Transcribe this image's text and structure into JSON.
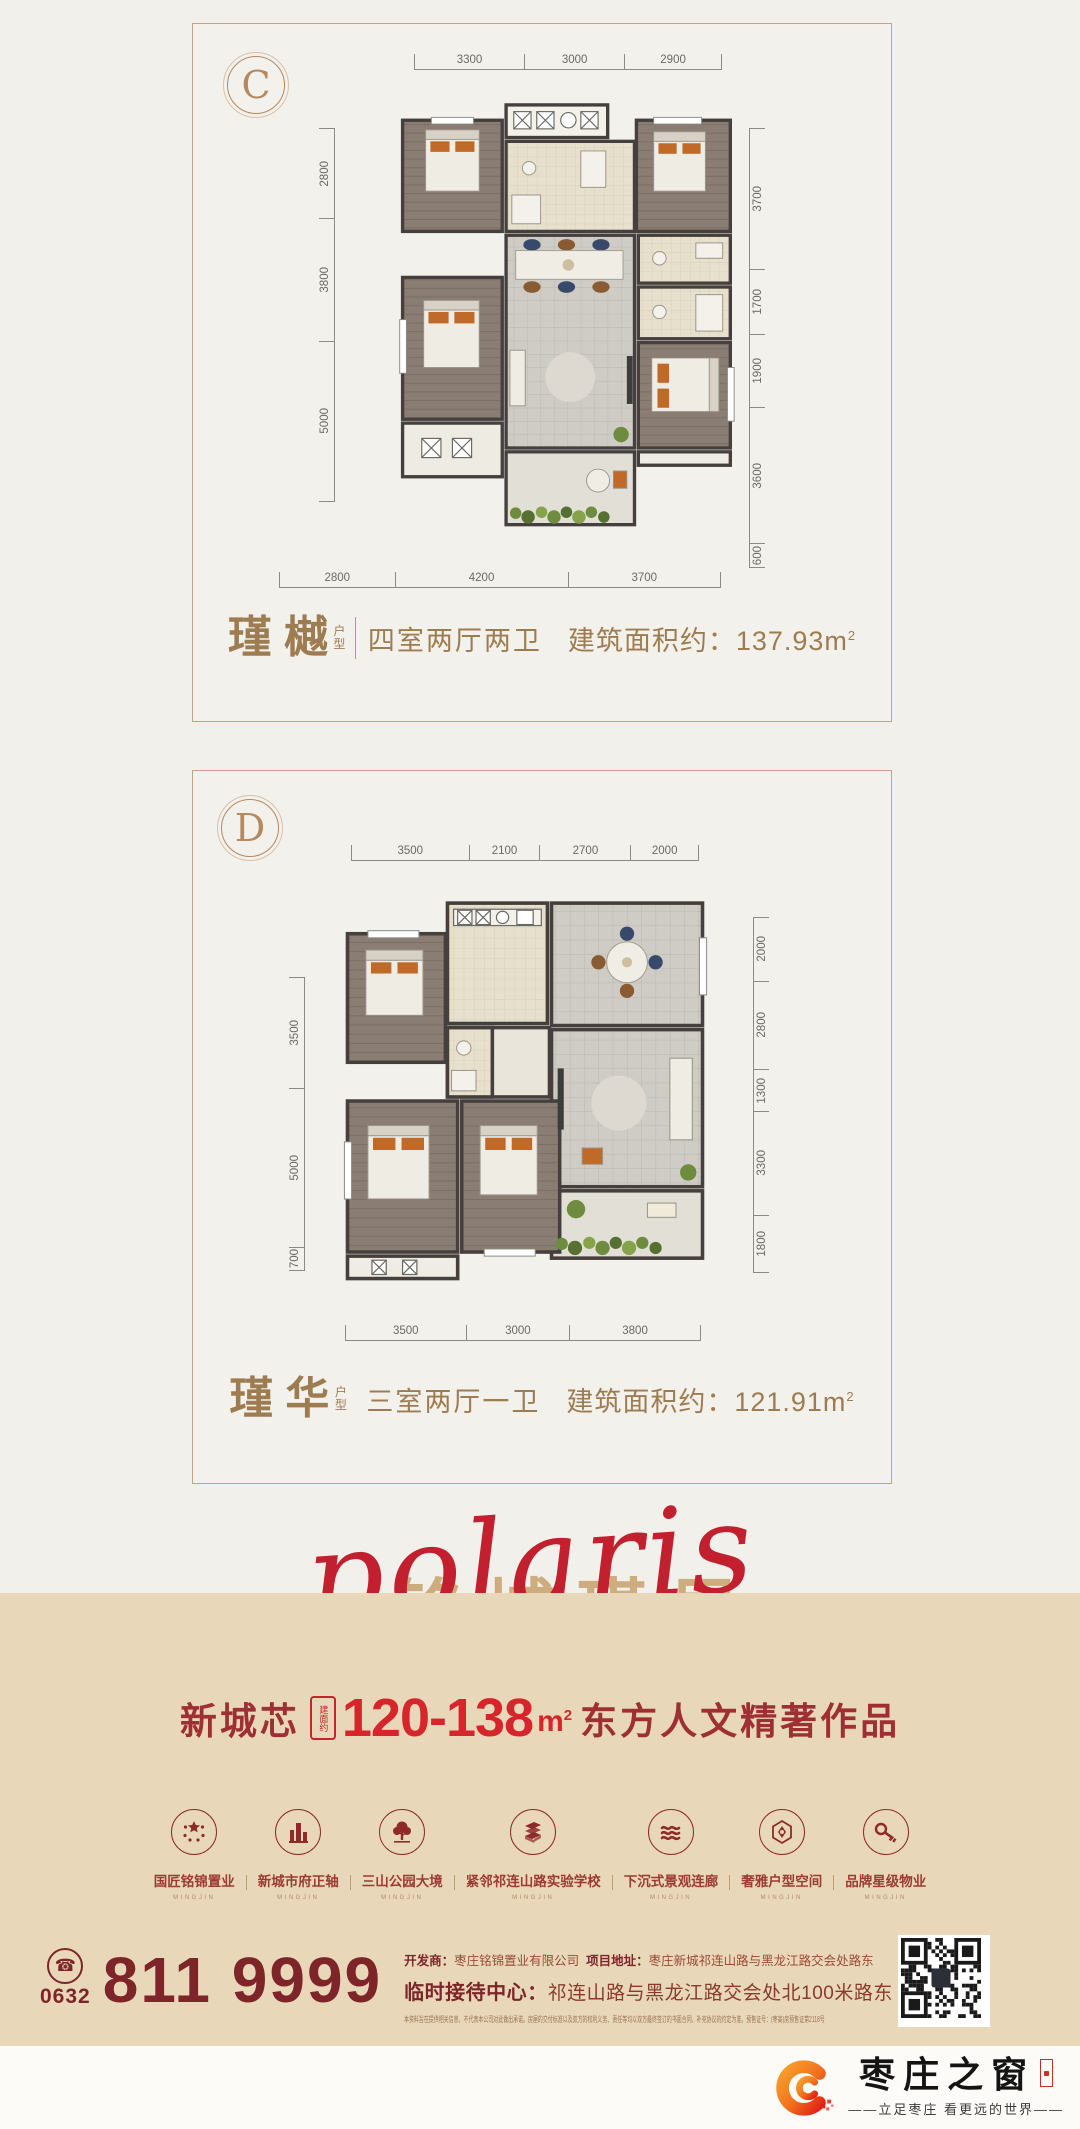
{
  "cards": [
    {
      "badge": "C",
      "name": "瑾樾",
      "type_label": "户型",
      "spec": "四室两厅两卫",
      "area_label": "建筑面积约：",
      "area_value": "137.93",
      "area_unit": "m",
      "area_sup": "2",
      "dims": {
        "top": [
          "3300",
          "3000",
          "2900"
        ],
        "left": [
          "2800",
          "3800",
          "5000"
        ],
        "right": [
          "3700",
          "1700",
          "1900",
          "3600",
          "600"
        ],
        "bottom": [
          "2800",
          "4200",
          "3700"
        ]
      }
    },
    {
      "badge": "D",
      "name": "瑾华",
      "type_label": "户型",
      "spec": "三室两厅一卫",
      "area_label": "建筑面积约：",
      "area_value": "121.91",
      "area_unit": "m",
      "area_sup": "2",
      "dims": {
        "top": [
          "3500",
          "2100",
          "2700",
          "2000"
        ],
        "left": [
          "3500",
          "5000",
          "700"
        ],
        "right": [
          "2000",
          "2800",
          "1300",
          "3300",
          "1800"
        ],
        "bottom": [
          "3500",
          "3000",
          "3800"
        ]
      }
    }
  ],
  "calligraphy": {
    "script": "polaris",
    "chinese": "铭城瑾里"
  },
  "headline": {
    "city": "新城芯",
    "seal": "建面约",
    "range": "120-138",
    "unit": "m",
    "sup": "2",
    "slogan": "东方人文精著作品"
  },
  "amenities": {
    "sub": "MINGJIN",
    "items": [
      {
        "icon": "stars-icon",
        "label": "国匠铭锦置业"
      },
      {
        "icon": "building-icon",
        "label": "新城市府正轴"
      },
      {
        "icon": "tree-icon",
        "label": "三山公园大境"
      },
      {
        "icon": "books-icon",
        "label": "紧邻祁连山路实验学校"
      },
      {
        "icon": "waves-icon",
        "label": "下沉式景观连廊"
      },
      {
        "icon": "lattice-icon",
        "label": "奢雅户型空间"
      },
      {
        "icon": "key-icon",
        "label": "品牌星级物业"
      }
    ]
  },
  "contact": {
    "area_code": "0632",
    "phone": "811 9999",
    "dev_label": "开发商：",
    "developer": "枣庄铭锦置业有限公司",
    "addr_label": "项目地址：",
    "address": "枣庄新城祁连山路与黑龙江路交会处路东",
    "reception_label": "临时接待中心：",
    "reception": "祁连山路与黑龙江路交会处北100米路东",
    "disclaimer": "本资料旨在提供相关信息，不代表本公司对此做出承诺。房屋的交付标准以及双方的权利义务、责任等均以双方最终签订的书面合同、补充协议的约定为准。预售证号：(枣高)房预售证第2118号"
  },
  "footer": {
    "brand": "枣庄之窗",
    "tagline": "——立足枣庄 看更远的世界——"
  },
  "colors": {
    "accent_red": "#c5262b",
    "dark_red": "#7d2528",
    "gold": "#9e7c51",
    "beige": "#e8d8b9"
  }
}
